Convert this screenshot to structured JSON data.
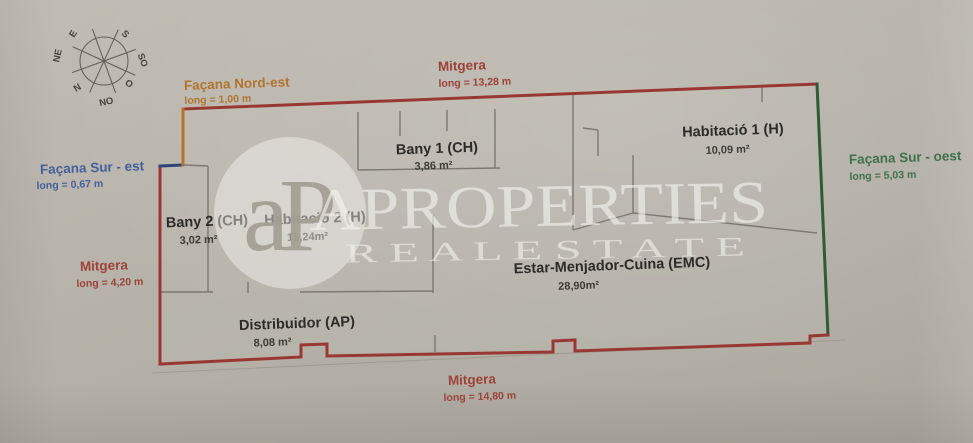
{
  "document": {
    "type": "apartment floor plan photo",
    "units": "m"
  },
  "compass": {
    "labels": [
      "E",
      "S",
      "NE",
      "SO",
      "N",
      "O",
      "NO"
    ]
  },
  "facades": {
    "nord_est": {
      "name": "Façana Nord-est",
      "length": "long = 1,00 m"
    },
    "mitgera_top": {
      "name": "Mitgera",
      "length": "long = 13,28 m"
    },
    "sur_est": {
      "name": "Façana Sur - est",
      "length": "long = 0,67 m"
    },
    "mitgera_left": {
      "name": "Mitgera",
      "length": "long = 4,20 m"
    },
    "sur_oest": {
      "name": "Façana Sur - oest",
      "length": "long = 5,03 m"
    },
    "mitgera_bottom": {
      "name": "Mitgera",
      "length": "long = 14,80 m"
    }
  },
  "rooms": [
    {
      "name": "Bany 1 (CH)",
      "area": "3,86 m²"
    },
    {
      "name": "Habitació 1 (H)",
      "area": "10,09 m²"
    },
    {
      "name": "Bany 2 (CH)",
      "area": "3,02 m²"
    },
    {
      "name": "Habitació 2 (H)",
      "area": "15,24m²"
    },
    {
      "name": "Estar-Menjador-Cuina (EMC)",
      "area": "28,90m²"
    },
    {
      "name": "Distribuidor (AP)",
      "area": "8,08 m²"
    }
  ],
  "watermark": {
    "logo": "aP",
    "brand": "APROPERTIES",
    "tagline": "R E A L   E S T A T E"
  },
  "colors": {
    "wall_red": "#993832",
    "wall_green": "#2e5c38",
    "wall_blue": "#2c4677",
    "wall_orange": "#b5742c",
    "interior_wall": "#6e6b62",
    "paper": "#b6b2a9",
    "text_red": "#9c4238",
    "text_orange": "#b1742e",
    "text_blue": "#44609b",
    "text_green": "#41704d"
  }
}
